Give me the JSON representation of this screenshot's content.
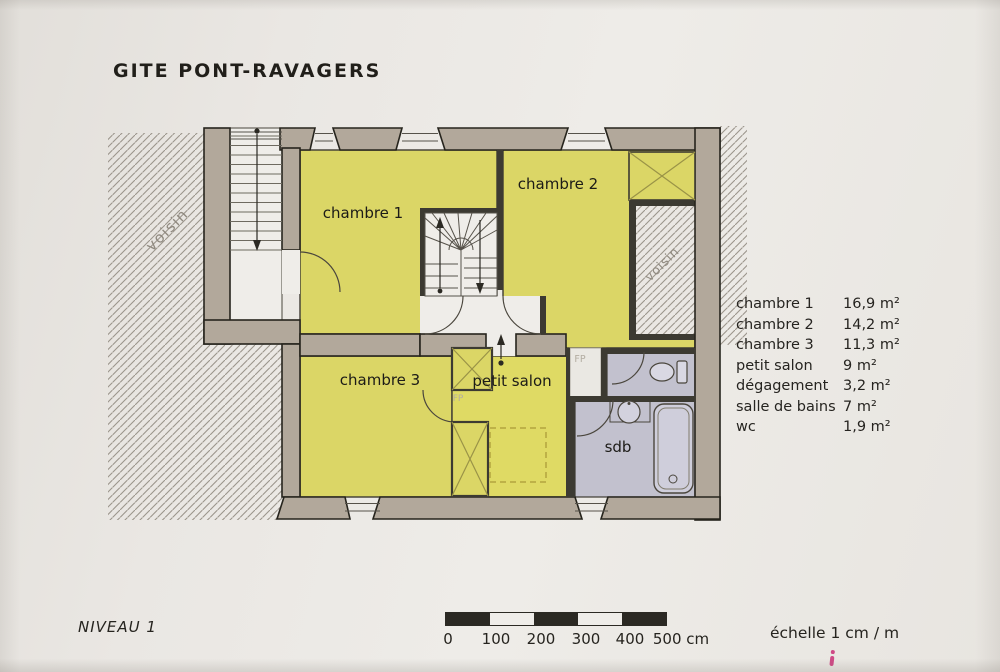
{
  "title": "GITE PONT-RAVAGERS",
  "level_label": "NIVEAU 1",
  "plan": {
    "rooms": {
      "chambre1": "chambre 1",
      "chambre2": "chambre 2",
      "chambre3": "chambre 3",
      "petit_salon": "petit salon",
      "sdb": "sdb"
    },
    "annotations": {
      "neighbor_left": "voisin",
      "neighbor_right": "voisin",
      "fireplace_1": "FP",
      "fireplace_2": "FP"
    }
  },
  "legend": {
    "rows": [
      {
        "label": "chambre 1",
        "area": "16,9 m²"
      },
      {
        "label": "chambre 2",
        "area": "14,2 m²"
      },
      {
        "label": "chambre 3",
        "area": "11,3 m²"
      },
      {
        "label": "petit salon",
        "area": "9 m²"
      },
      {
        "label": "dégagement",
        "area": "3,2 m²"
      },
      {
        "label": "salle de bains",
        "area": "7 m²"
      },
      {
        "label": "wc",
        "area": "1,9 m²"
      }
    ]
  },
  "scale_bar": {
    "tick_labels": [
      "0",
      "100",
      "200",
      "300",
      "400",
      "500 cm"
    ],
    "caption": "échelle 1 cm / m"
  },
  "colors": {
    "paper": "#e9e6e2",
    "wall": "#b2a89b",
    "room_yellow": "#dbd666",
    "bathroom_lavender": "#c2c1ce",
    "hatch_line": "#9b958c"
  }
}
